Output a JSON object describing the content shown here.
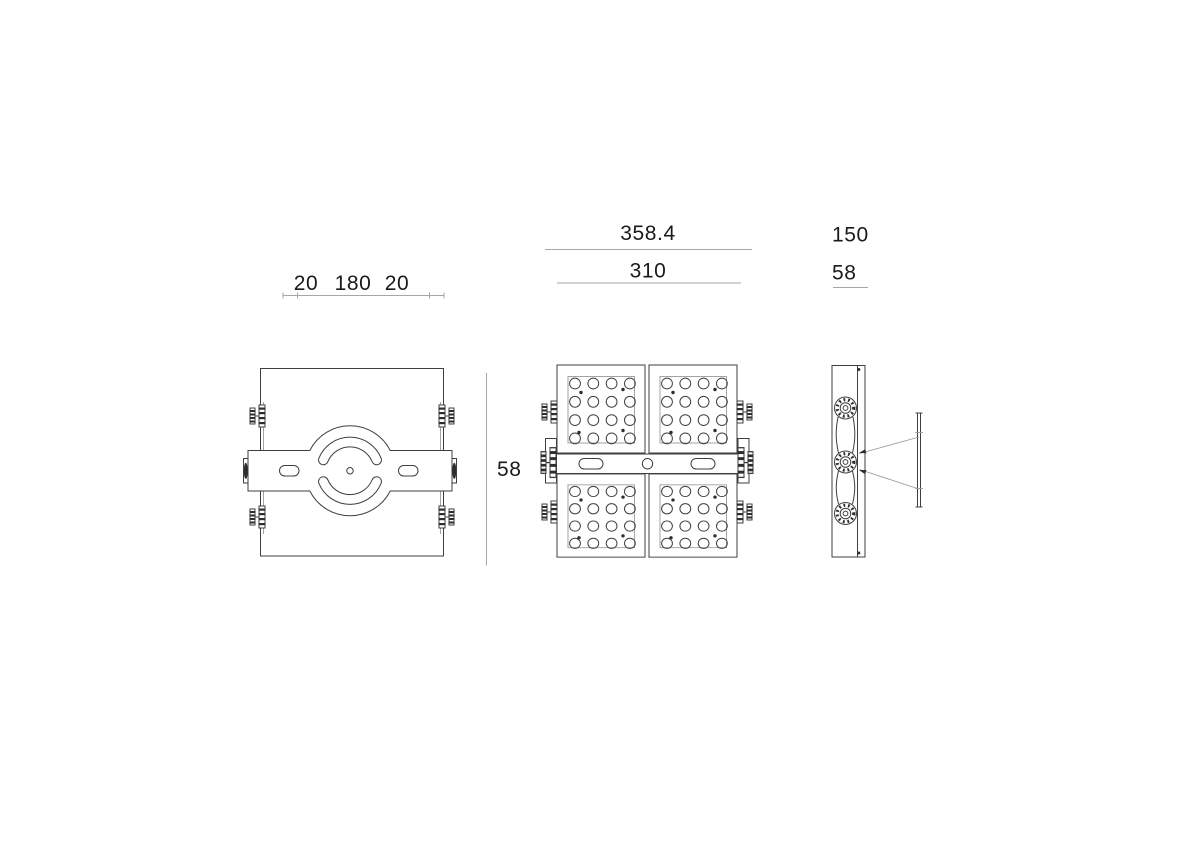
{
  "colors": {
    "line": "#3f3f3f",
    "thin": "#9a9a9a",
    "dim": "#a6a6a6",
    "text": "#1a1a1a",
    "dark": "#2e2e2e",
    "bg": "#ffffff"
  },
  "dimension_labels": {
    "back_top": [
      "20",
      "180",
      "20"
    ],
    "front_total_width": "358.4",
    "front_body_width": "310",
    "body_depth": "58",
    "side_width": "150",
    "side_depth": "58"
  }
}
